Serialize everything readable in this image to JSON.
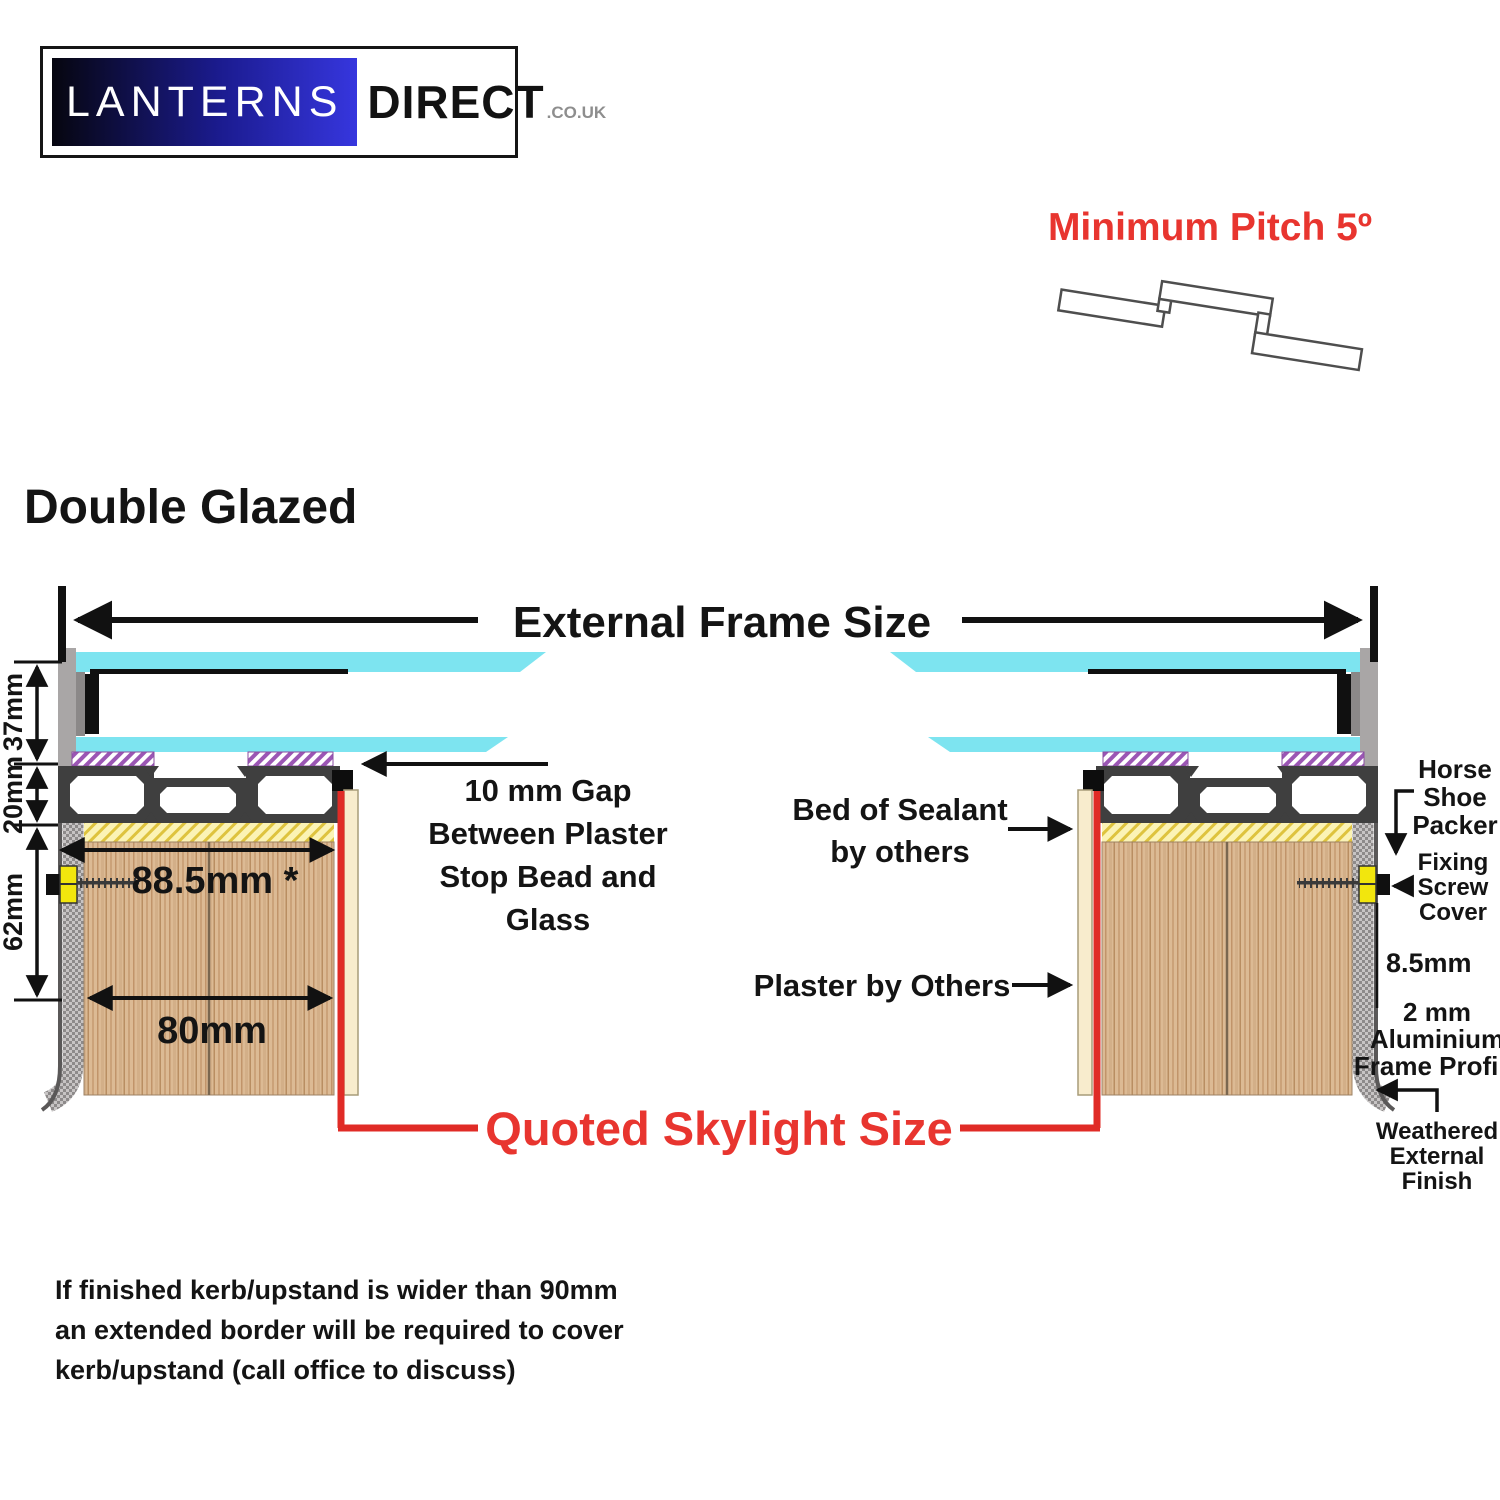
{
  "colors": {
    "accent_red": "#e8352f",
    "glass_cyan": "#7de4f0",
    "frame_gray": "#a9a6a6",
    "profile_dark": "#3f3f3f",
    "sealant_yellow": "#fbf3b5",
    "purple_gasket": "#9b56b4",
    "wood_tan": "#dcba94",
    "packer_yellow": "#f2e60d",
    "plaster_tan": "#f8eccd",
    "logo_blue": "#3636de"
  },
  "logo": {
    "brand_primary": "LANTERNS",
    "brand_secondary": "DIRECT",
    "brand_suffix": ".CO.UK"
  },
  "pitch": {
    "label": "Minimum Pitch 5º"
  },
  "section_title": "Double Glazed",
  "diagram": {
    "external_frame_size": "External Frame Size",
    "quoted_skylight_size": "Quoted Skylight Size",
    "dims": {
      "glazing": "37mm",
      "profile": "20mm",
      "upstand": "62mm",
      "outer_width": "88.5mm *",
      "inner_width": "80mm",
      "offset": "8.5mm"
    },
    "labels": {
      "gap": [
        "10 mm Gap",
        "Between Plaster",
        "Stop Bead and",
        "Glass"
      ],
      "sealant": [
        "Bed of Sealant",
        "by others"
      ],
      "plaster": "Plaster by Others",
      "horseshoe": [
        "Horse",
        "Shoe",
        "Packer"
      ],
      "screw": [
        "Fixing",
        "Screw",
        "Cover"
      ],
      "frame_profile": [
        "2 mm",
        "Aluminium",
        "Frame Profile"
      ],
      "weathered": [
        "Weathered",
        "External",
        "Finish"
      ]
    }
  },
  "footnote": {
    "lines": [
      "If finished kerb/upstand is wider than 90mm",
      "an extended border will be required to cover",
      "kerb/upstand (call office to discuss)"
    ]
  }
}
